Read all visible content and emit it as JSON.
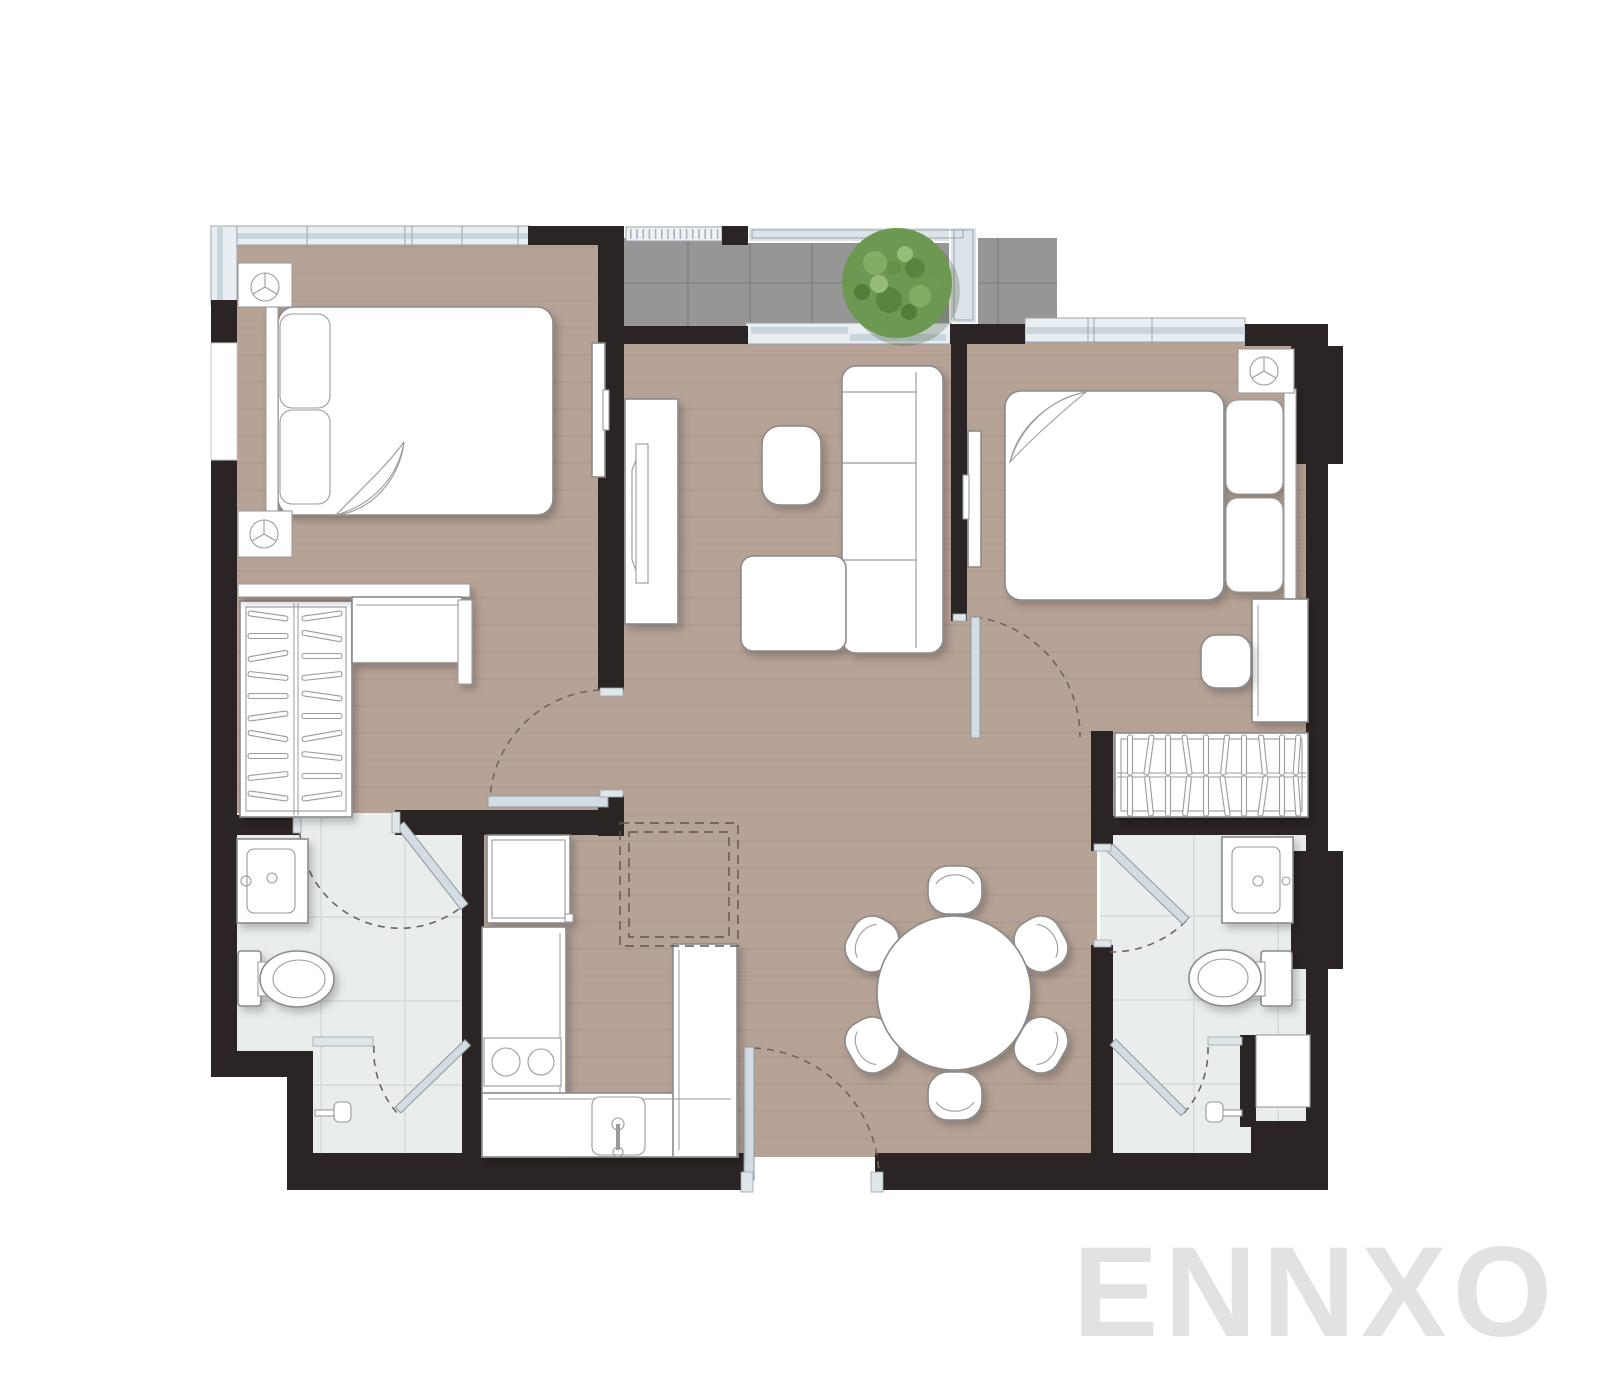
{
  "watermark": {
    "text": "ENNXO"
  },
  "colors": {
    "wall": "#2a2524",
    "wood_floor": "#b7a296",
    "plank_line": "#a18b80",
    "bath_floor": "#e9edec",
    "tile_line": "#d2dbd8",
    "balcony_floor": "#969696",
    "balcony_line": "#7f7f7f",
    "glass": "#cfdae1",
    "outline": "#8a8a8a",
    "dash": "#6f645c",
    "plant": "#6d9851",
    "watermark": "#e2e2e2"
  },
  "plan": {
    "title": "2-bedroom apartment floor plan",
    "rooms": [
      {
        "name": "bedroom-1",
        "furniture": [
          "double bed with folded sheet",
          "2 pillows",
          "2 nightstands with lamp symbol",
          "wardrobe with hangers",
          "dressing desk with shelf",
          "wall-mounted TV",
          "corner window"
        ]
      },
      {
        "name": "living-room",
        "furniture": [
          "3-seat sofa",
          "chaise ottoman",
          "rounded side table",
          "TV console with TV",
          "sliding balcony door"
        ]
      },
      {
        "name": "balcony",
        "furniture": [
          "round shrub plant",
          "gray tile floor",
          "railing",
          "AC louver ledge"
        ]
      },
      {
        "name": "bedroom-2",
        "furniture": [
          "double bed with folded sheet",
          "2 pillows",
          "nightstand with lamp symbol",
          "side desk",
          "stool",
          "wardrobe with hangers",
          "wall-mounted TV",
          "window"
        ]
      },
      {
        "name": "bathroom-1",
        "furniture": [
          "vanity sink",
          "toilet",
          "glass shower door",
          "towel bar",
          "shower head"
        ]
      },
      {
        "name": "bathroom-2",
        "furniture": [
          "vanity sink",
          "toilet",
          "glass shower door",
          "towel bar",
          "shower head",
          "shower niche shelf"
        ]
      },
      {
        "name": "kitchen",
        "furniture": [
          "refrigerator",
          "U-shaped counter",
          "2-burner cooktop",
          "sink with faucet",
          "overhead cabinets shown dashed"
        ]
      },
      {
        "name": "dining-area",
        "furniture": [
          "round dining table",
          "6 chairs"
        ]
      },
      {
        "name": "entrance",
        "furniture": [
          "entry door with swing arc"
        ]
      }
    ]
  }
}
